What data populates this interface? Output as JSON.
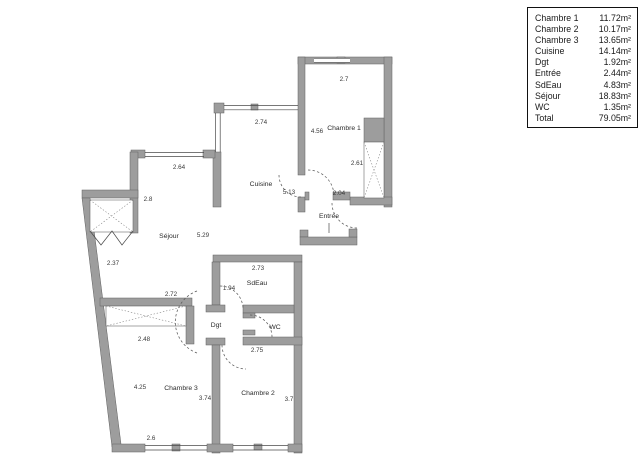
{
  "legend": {
    "rows": [
      {
        "label": "Chambre 1",
        "value": "11.72m²"
      },
      {
        "label": "Chambre 2",
        "value": "10.17m²"
      },
      {
        "label": "Chambre 3",
        "value": "13.65m²"
      },
      {
        "label": "Cuisine",
        "value": "14.14m²"
      },
      {
        "label": "Dgt",
        "value": "1.92m²"
      },
      {
        "label": "Entrée",
        "value": "2.44m²"
      },
      {
        "label": "SdEau",
        "value": "4.83m²"
      },
      {
        "label": "Séjour",
        "value": "18.83m²"
      },
      {
        "label": "WC",
        "value": "1.35m²"
      },
      {
        "label": "Total",
        "value": "79.05m²"
      }
    ]
  },
  "plan": {
    "rooms": {
      "chambre1": "Chambre 1",
      "chambre2": "Chambre 2",
      "chambre3": "Chambre 3",
      "cuisine": "Cuisine",
      "sejour": "Séjour",
      "entree": "Entrée",
      "sdeau": "SdEau",
      "dgt": "Dgt",
      "wc": "WC"
    },
    "dims": {
      "c1_top": "2.7",
      "c1_left": "4.56",
      "c1_right": "2.61",
      "c1_bottom": "2.04",
      "cuisine_top": "2.74",
      "cuisine_height": "5.13",
      "sejour_top": "2.64",
      "sejour_left": "2.8",
      "sejour_width": "5.29",
      "sejour_diag": "2.37",
      "sdeau_top": "2.73",
      "dgt_height": "1.94",
      "c3_top": "2.72",
      "c3_window": "2.48",
      "wc_bottom": "2.75",
      "c3_left": "4.25",
      "c3_right": "3.74",
      "c2_right": "3.7",
      "c3_bottom": "2.6"
    },
    "colors": {
      "wall": "#9d9d9d",
      "wall_outline": "#606060",
      "line": "#4a4a4a",
      "text": "#2b2b2b"
    }
  }
}
